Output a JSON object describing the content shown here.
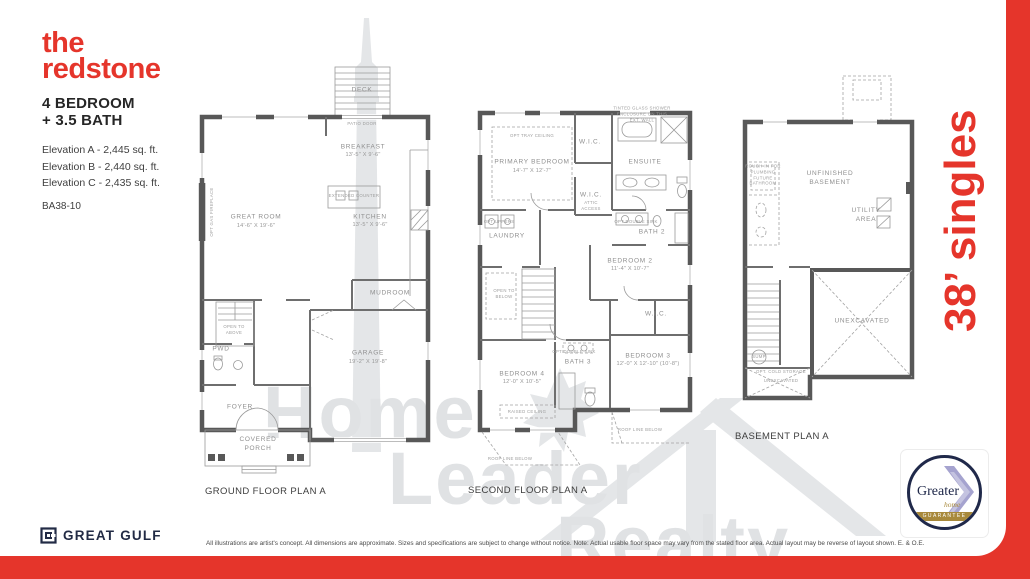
{
  "colors": {
    "accent_red": "#e5352b",
    "brand_navy": "#222b45",
    "badge_gold": "#a8893b",
    "badge_purple": "#a5a3cf"
  },
  "header": {
    "title_line1": "the",
    "title_line2": "redstone",
    "subtitle_line1": "4 BEDROOM",
    "subtitle_line2": "+ 3.5 BATH",
    "elevations": [
      {
        "label": "Elevation A - 2,445 sq. ft."
      },
      {
        "label": "Elevation B - 2,440 sq. ft."
      },
      {
        "label": "Elevation C - 2,435 sq. ft."
      }
    ],
    "model_code": "BA38-10"
  },
  "side_banner": {
    "text": "38’ singles"
  },
  "watermark": {
    "word1": "Home",
    "word2": "Leader",
    "word3": "Realty"
  },
  "plans": {
    "ground": {
      "caption": "GROUND FLOOR PLAN A",
      "deck": "DECK",
      "patio_door": "PATIO DOOR",
      "great_room": {
        "label": "GREAT ROOM",
        "dims": "14'-6\" X 19'-6\""
      },
      "opt_gas_fireplace": "OPT GAS FIREPLACE",
      "breakfast": {
        "label": "BREAKFAST",
        "dims": "13'-5\" X 9'-6\""
      },
      "kitchen": {
        "label": "KITCHEN",
        "dims": "13'-5\" X 9'-6\""
      },
      "extended_counter": "EXTENDED COUNTER",
      "mudroom": "MUDROOM",
      "open_to_above": "OPEN TO ABOVE",
      "pwd": "PWD",
      "foyer": "FOYER",
      "covered_porch": "COVERED PORCH",
      "garage": {
        "label": "GARAGE",
        "dims": "19'-2\" X 19'-8\""
      }
    },
    "second": {
      "caption": "SECOND FLOOR PLAN A",
      "tinted_glass_note": "TINTED GLASS SHOWER ENCLOSURE ON THIS EXT. WALL",
      "opt_tray_ceiling": "OPT TRAY CEILING",
      "primary": {
        "label": "PRIMARY BEDROOM",
        "dims": "14'-7\" X 12'-7\""
      },
      "wic": "W.I.C.",
      "ensuite": "ENSUITE",
      "bath2": "BATH 2",
      "opt_double_sink": "OPT DOUBLE SINK",
      "attic_access": "ATTIC ACCESS",
      "laundry": "LAUNDRY",
      "opt_uppers": "OPT UPPERS",
      "open_to_below": "OPEN TO BELOW",
      "bedroom2": {
        "label": "BEDROOM 2",
        "dims": "11'-4\" X 10'-7\""
      },
      "bedroom3": {
        "label": "BEDROOM 3",
        "dims": "12'-0\" X 12'-10\" (10'-8\")"
      },
      "bedroom4": {
        "label": "BEDROOM 4",
        "dims": "12'-0\" X 10'-5\""
      },
      "bath3": "BATH 3",
      "raised_ceiling": "RAISED CEILING",
      "roof_line_below": "ROOF LINE BELOW"
    },
    "basement": {
      "caption": "BASEMENT PLAN A",
      "unfinished_basement": "UNFINISHED BASEMENT",
      "utility_area": "UTILITY AREA",
      "unexcavated": "UNEXCAVATED",
      "rough_in_note": "ROUGH-IN FOR PLUMBING FUTURE BATHROOM",
      "sump": "SUMP",
      "opt_cold_storage": "OPT. COLD STORAGE"
    }
  },
  "badge": {
    "brand": "Greater",
    "sub": "home",
    "banner": "GUARANTEE"
  },
  "footer": {
    "brand": "GREAT GULF",
    "disclaimer": "All illustrations are artist's concept. All dimensions are approximate. Sizes and specifications are subject to change without notice. Note: Actual usable floor space may vary from the stated floor area. Actual layout may be reverse of layout shown. E. & O.E."
  }
}
